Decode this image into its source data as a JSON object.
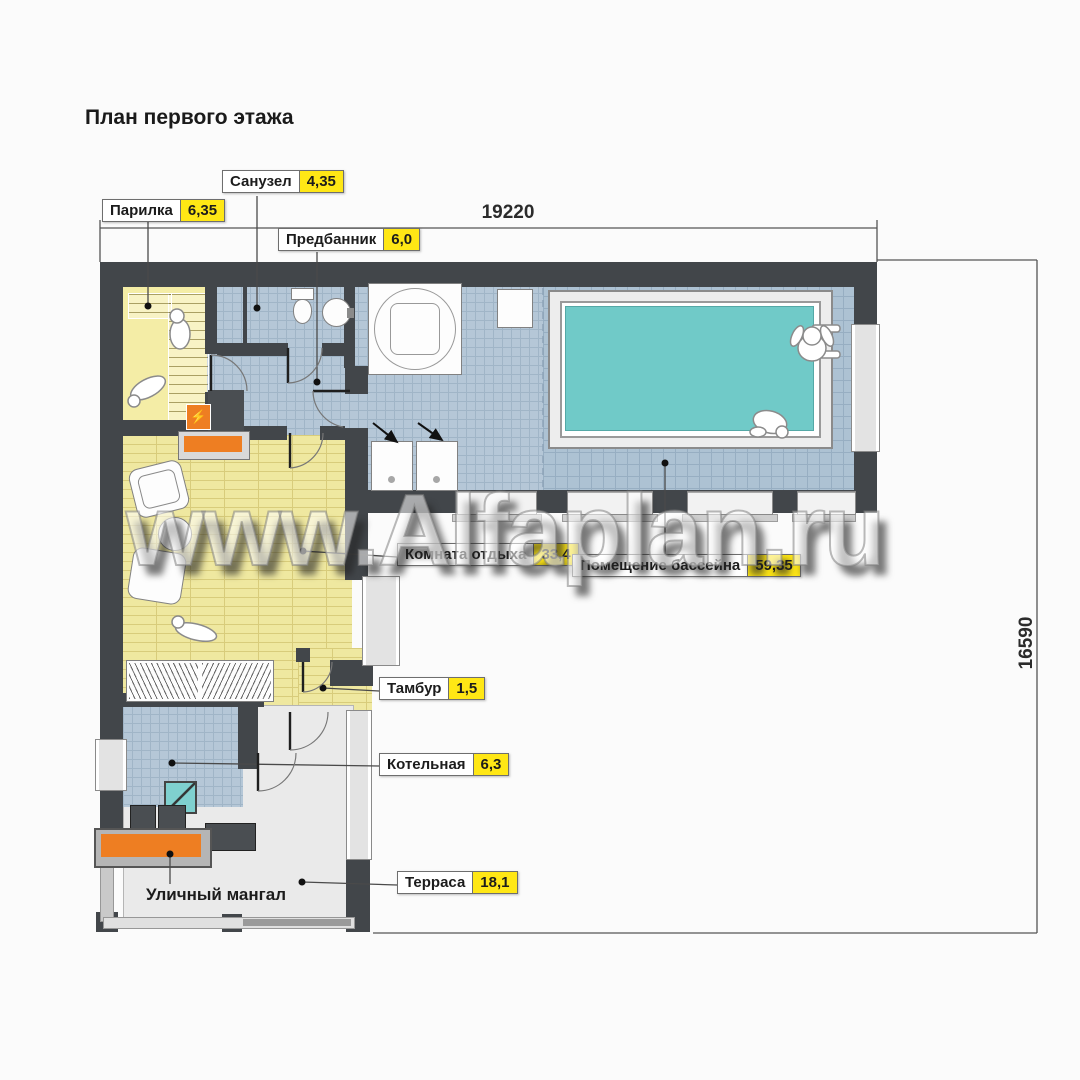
{
  "title": "План первого этажа",
  "watermark": "www.Alfaplan.ru",
  "dims": {
    "top": "19220",
    "right": "16590"
  },
  "labels": {
    "parilka": {
      "name": "Парилка",
      "area": "6,35"
    },
    "sanuzel": {
      "name": "Санузел",
      "area": "4,35"
    },
    "predbannik": {
      "name": "Предбанник",
      "area": "6,0"
    },
    "komnata": {
      "name": "Комната отдыха",
      "area": "33,4"
    },
    "bassein": {
      "name": "Помещение бассейна",
      "area": "59,35"
    },
    "tambur": {
      "name": "Тамбур",
      "area": "1,5"
    },
    "kotelnaya": {
      "name": "Котельная",
      "area": "6,3"
    },
    "terrasa": {
      "name": "Терраса",
      "area": "18,1"
    },
    "mangal": {
      "name": "Уличный мангал"
    }
  },
  "colors": {
    "wall": "#42464a",
    "area_badge": "#ffe715",
    "pool_water": "#70cac8",
    "stove": "#ee7e22"
  }
}
